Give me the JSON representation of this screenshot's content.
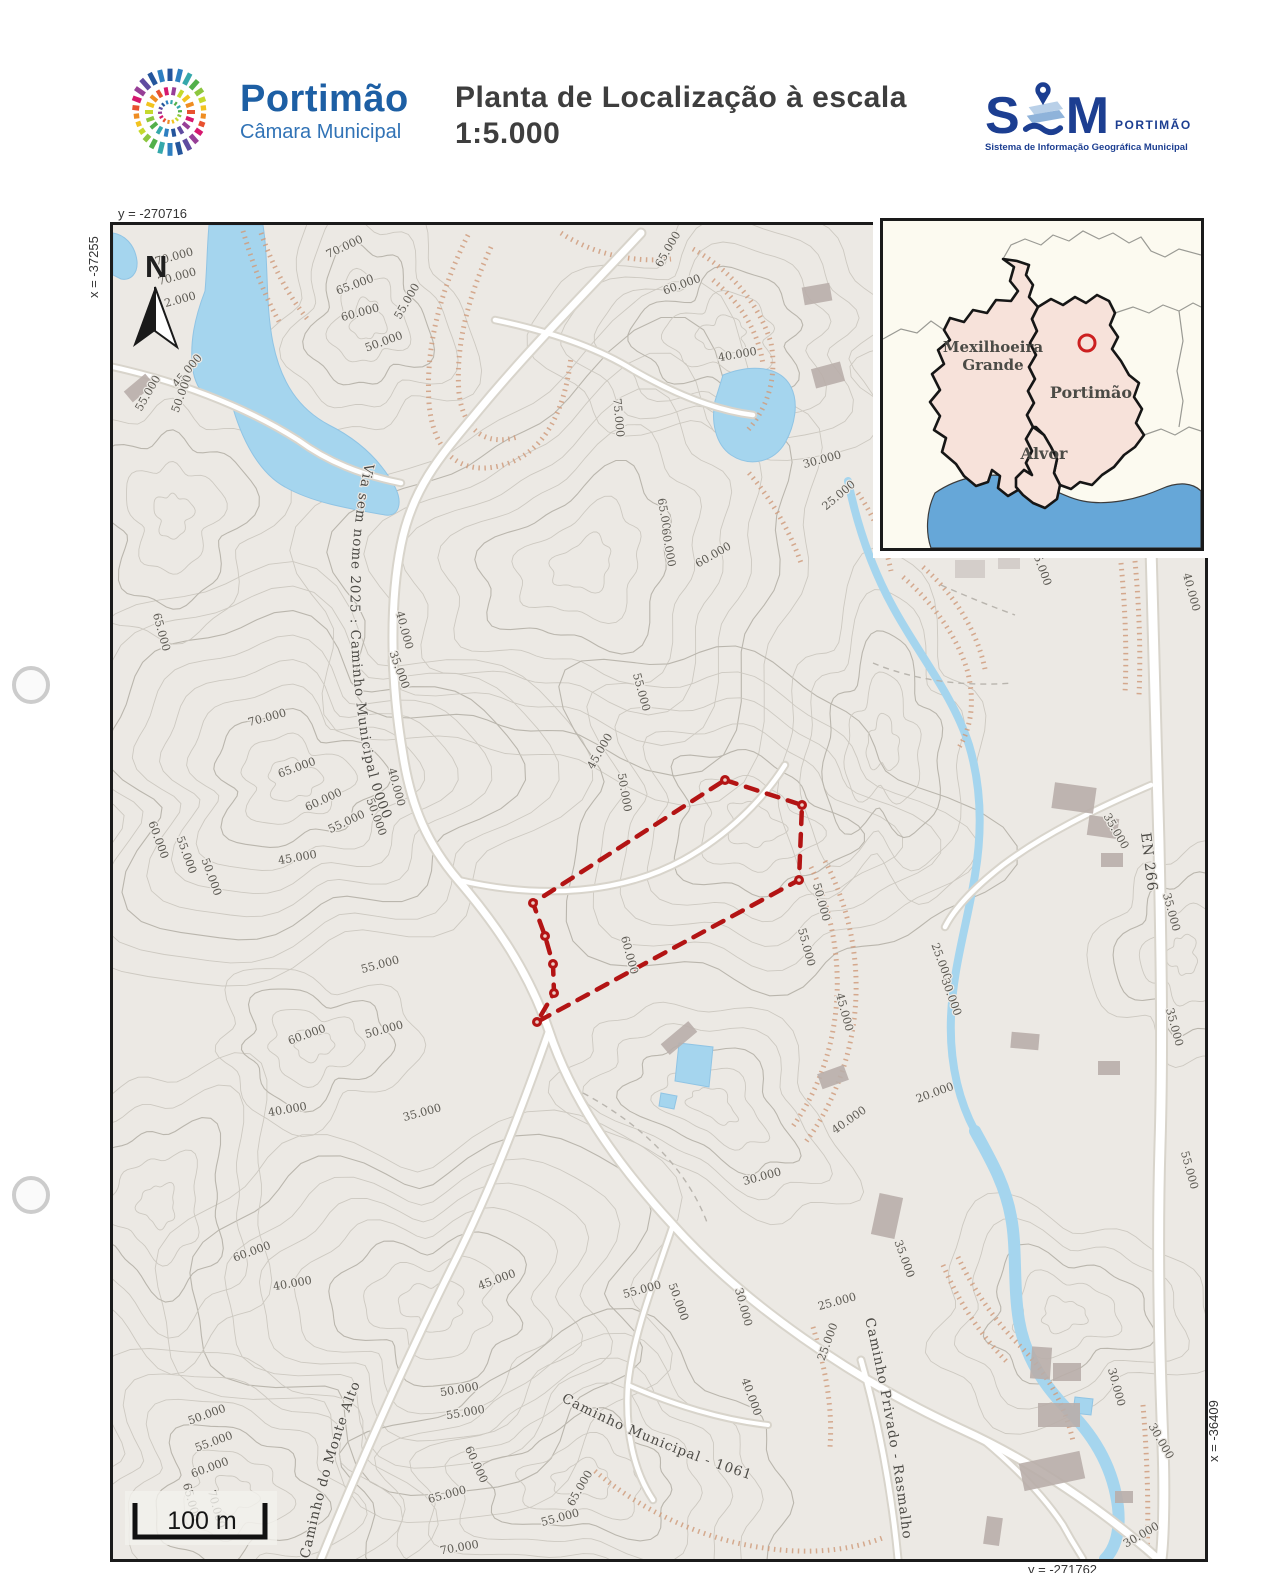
{
  "header": {
    "logo": {
      "name": "Portimão",
      "subtitle": "Câmara Municipal"
    },
    "title_line1": "Planta de Localização à escala",
    "title_line2": "1:5.000",
    "sim_logo": {
      "s": "S",
      "m": "M",
      "brand": "PORTIMÃO",
      "subtitle": "Sistema de Informação Geográfica Municipal",
      "icon": "map-pin-layers-icon"
    },
    "logo_palette": [
      "#24559c",
      "#2e7fc1",
      "#35a8ab",
      "#52b04a",
      "#8cc63f",
      "#c5d92d",
      "#f2c31f",
      "#ef8d22",
      "#e8512f",
      "#d6186e",
      "#973f97",
      "#5f4ba0"
    ]
  },
  "map": {
    "frame": {
      "top_y": "y = -270716",
      "left_x": "x = -37255",
      "right_x": "x = -36409",
      "bottom_y": "y = -271762"
    },
    "north_label": "N",
    "scale_label": "100 m",
    "en_road_label": "EN 266",
    "place_labels": [
      {
        "text": "Rasmalho",
        "x": 958,
        "y": 333
      }
    ],
    "road_labels": [
      {
        "text": "Via sem nome 2025 : Caminho Municipal 0000",
        "path": "M 252,238 C 232,330 234,430 250,524 C 260,580 280,622 310,656 C 344,696 372,740 392,795"
      },
      {
        "text": "Caminho do Monte Alto",
        "path": "M 196,1334 C 210,1268 228,1202 255,1140"
      },
      {
        "text": "Caminho Municipal - 1061",
        "path": "M 448,1176 C 520,1214 600,1244 668,1264"
      },
      {
        "text": "Caminho Privado - Rasmalho",
        "path": "M 752,1094 C 768,1160 782,1240 792,1330"
      }
    ],
    "contour_labels": [
      [
        "70.000",
        62,
        35,
        -15
      ],
      [
        "70.000",
        65,
        55,
        -15
      ],
      [
        "2.000",
        68,
        78,
        -15
      ],
      [
        "70.000",
        233,
        25,
        -25
      ],
      [
        "65.000",
        243,
        63,
        -20
      ],
      [
        "60.000",
        248,
        91,
        -15
      ],
      [
        "55.000",
        297,
        78,
        -60
      ],
      [
        "50.000",
        272,
        120,
        -20
      ],
      [
        "45.000",
        77,
        148,
        -50
      ],
      [
        "50.000",
        72,
        170,
        -70
      ],
      [
        "55.000",
        38,
        170,
        -60
      ],
      [
        "65.000",
        558,
        26,
        -60
      ],
      [
        "60.000",
        570,
        63,
        -20
      ],
      [
        "40.000",
        625,
        133,
        -10
      ],
      [
        "75.000",
        502,
        193,
        85
      ],
      [
        "30.000",
        710,
        238,
        -15
      ],
      [
        "25.000",
        728,
        273,
        -40
      ],
      [
        "65.000",
        548,
        293,
        80
      ],
      [
        "60.000",
        552,
        323,
        80
      ],
      [
        "60.000",
        602,
        333,
        -30
      ],
      [
        "65.000",
        45,
        408,
        75
      ],
      [
        "70.000",
        155,
        496,
        -15
      ],
      [
        "65.000",
        185,
        546,
        -20
      ],
      [
        "60.000",
        212,
        578,
        -25
      ],
      [
        "55.000",
        235,
        600,
        -25
      ],
      [
        "50.000",
        260,
        593,
        70
      ],
      [
        "40.000",
        288,
        406,
        75
      ],
      [
        "35.000",
        283,
        446,
        70
      ],
      [
        "40.000",
        280,
        563,
        75
      ],
      [
        "60.000",
        42,
        616,
        70
      ],
      [
        "55.000",
        70,
        631,
        70
      ],
      [
        "50.000",
        95,
        653,
        70
      ],
      [
        "45.000",
        185,
        636,
        -10
      ],
      [
        "55.000",
        525,
        468,
        75
      ],
      [
        "45.000",
        490,
        528,
        -60
      ],
      [
        "50.000",
        508,
        568,
        80
      ],
      [
        "60.000",
        513,
        731,
        75
      ],
      [
        "50.000",
        705,
        678,
        75
      ],
      [
        "55.000",
        690,
        723,
        75
      ],
      [
        "45.000",
        728,
        788,
        75
      ],
      [
        "25.000",
        825,
        738,
        70
      ],
      [
        "30.000",
        835,
        773,
        70
      ],
      [
        "20.000",
        823,
        871,
        -20
      ],
      [
        "40.000",
        738,
        898,
        -35
      ],
      [
        "30.000",
        650,
        955,
        -15
      ],
      [
        "35.000",
        788,
        1035,
        70
      ],
      [
        "25.000",
        725,
        1080,
        -15
      ],
      [
        "30.000",
        627,
        1083,
        75
      ],
      [
        "35.000",
        1000,
        608,
        60
      ],
      [
        "35.000",
        1055,
        688,
        75
      ],
      [
        "35.000",
        1058,
        803,
        75
      ],
      [
        "55.000",
        1073,
        946,
        75
      ],
      [
        "30.000",
        1000,
        1163,
        75
      ],
      [
        "30.000",
        1045,
        1218,
        60
      ],
      [
        "30.000",
        1030,
        1313,
        -30
      ],
      [
        "35.000",
        925,
        343,
        70
      ],
      [
        "40.000",
        1075,
        368,
        75
      ],
      [
        "60.000",
        140,
        1030,
        -20
      ],
      [
        "40.000",
        180,
        1062,
        -10
      ],
      [
        "55.000",
        268,
        743,
        -15
      ],
      [
        "50.000",
        272,
        808,
        -15
      ],
      [
        "60.000",
        195,
        813,
        -20
      ],
      [
        "40.000",
        175,
        888,
        -10
      ],
      [
        "35.000",
        310,
        891,
        -15
      ],
      [
        "50.000",
        347,
        1168,
        -10
      ],
      [
        "55.000",
        353,
        1191,
        -10
      ],
      [
        "60.000",
        360,
        1241,
        65
      ],
      [
        "65.000",
        335,
        1273,
        -15
      ],
      [
        "70.000",
        347,
        1326,
        -10
      ],
      [
        "65.000",
        470,
        1265,
        -60
      ],
      [
        "55.000",
        448,
        1296,
        -15
      ],
      [
        "50.000",
        95,
        1193,
        -20
      ],
      [
        "55.000",
        102,
        1220,
        -20
      ],
      [
        "60.000",
        98,
        1246,
        -20
      ],
      [
        "65.000",
        75,
        1278,
        75
      ],
      [
        "70.000",
        100,
        1285,
        75
      ],
      [
        "55.000",
        530,
        1068,
        -15
      ],
      [
        "50.000",
        562,
        1078,
        70
      ],
      [
        "40.000",
        635,
        1173,
        70
      ],
      [
        "45.000",
        385,
        1058,
        -20
      ],
      [
        "25.000",
        718,
        1118,
        -70
      ]
    ],
    "parcel": {
      "color": "#b31414",
      "vertices": [
        [
          612,
          555
        ],
        [
          689,
          580
        ],
        [
          686,
          655
        ],
        [
          424,
          797
        ],
        [
          441,
          768
        ],
        [
          440,
          739
        ],
        [
          432,
          711
        ],
        [
          420,
          678
        ]
      ]
    }
  },
  "inset": {
    "regions": [
      {
        "name": "Mexilhoeira Grande",
        "line1": "Mexilhoeira",
        "line2": "Grande"
      },
      {
        "name": "Portimão"
      },
      {
        "name": "Alvor"
      }
    ],
    "marker": "red-circle-marker"
  },
  "colors": {
    "brand_blue": "#1d5fa4",
    "sim_navy": "#1c3e91",
    "parcel_red": "#b31414",
    "water": "#a5d5ee",
    "inset_region_fill": "#f7e2da",
    "inset_sea": "#66a7d8",
    "map_bg": "#ece9e4"
  }
}
